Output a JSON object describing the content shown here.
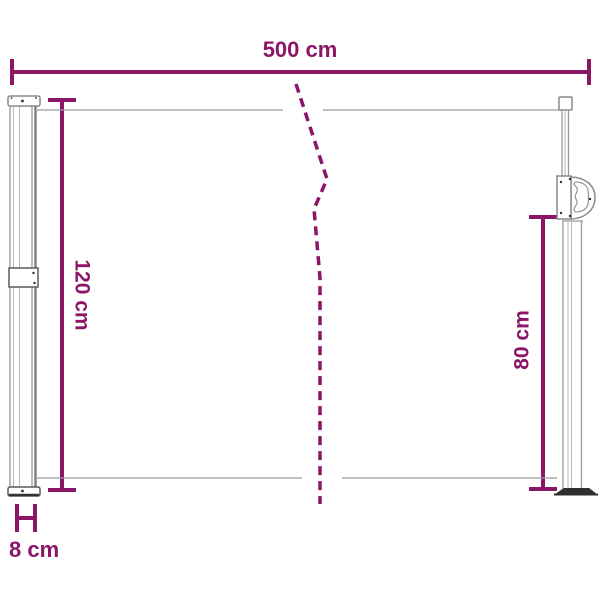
{
  "diagram": {
    "kind": "product-dimension-diagram",
    "dimensions": {
      "width": {
        "label": "500 cm",
        "value": 500,
        "unit": "cm"
      },
      "height_left": {
        "label": "120 cm",
        "value": 120,
        "unit": "cm"
      },
      "height_right": {
        "label": "80 cm",
        "value": 80,
        "unit": "cm"
      },
      "depth": {
        "label": "8 cm",
        "value": 8,
        "unit": "cm"
      }
    },
    "colors": {
      "dimension_accent": "#8B1566",
      "outline_gray": "#9a9a9a",
      "outline_dark": "#5a5a5a",
      "base_dark": "#2f2f2f",
      "background": "#ffffff"
    }
  }
}
